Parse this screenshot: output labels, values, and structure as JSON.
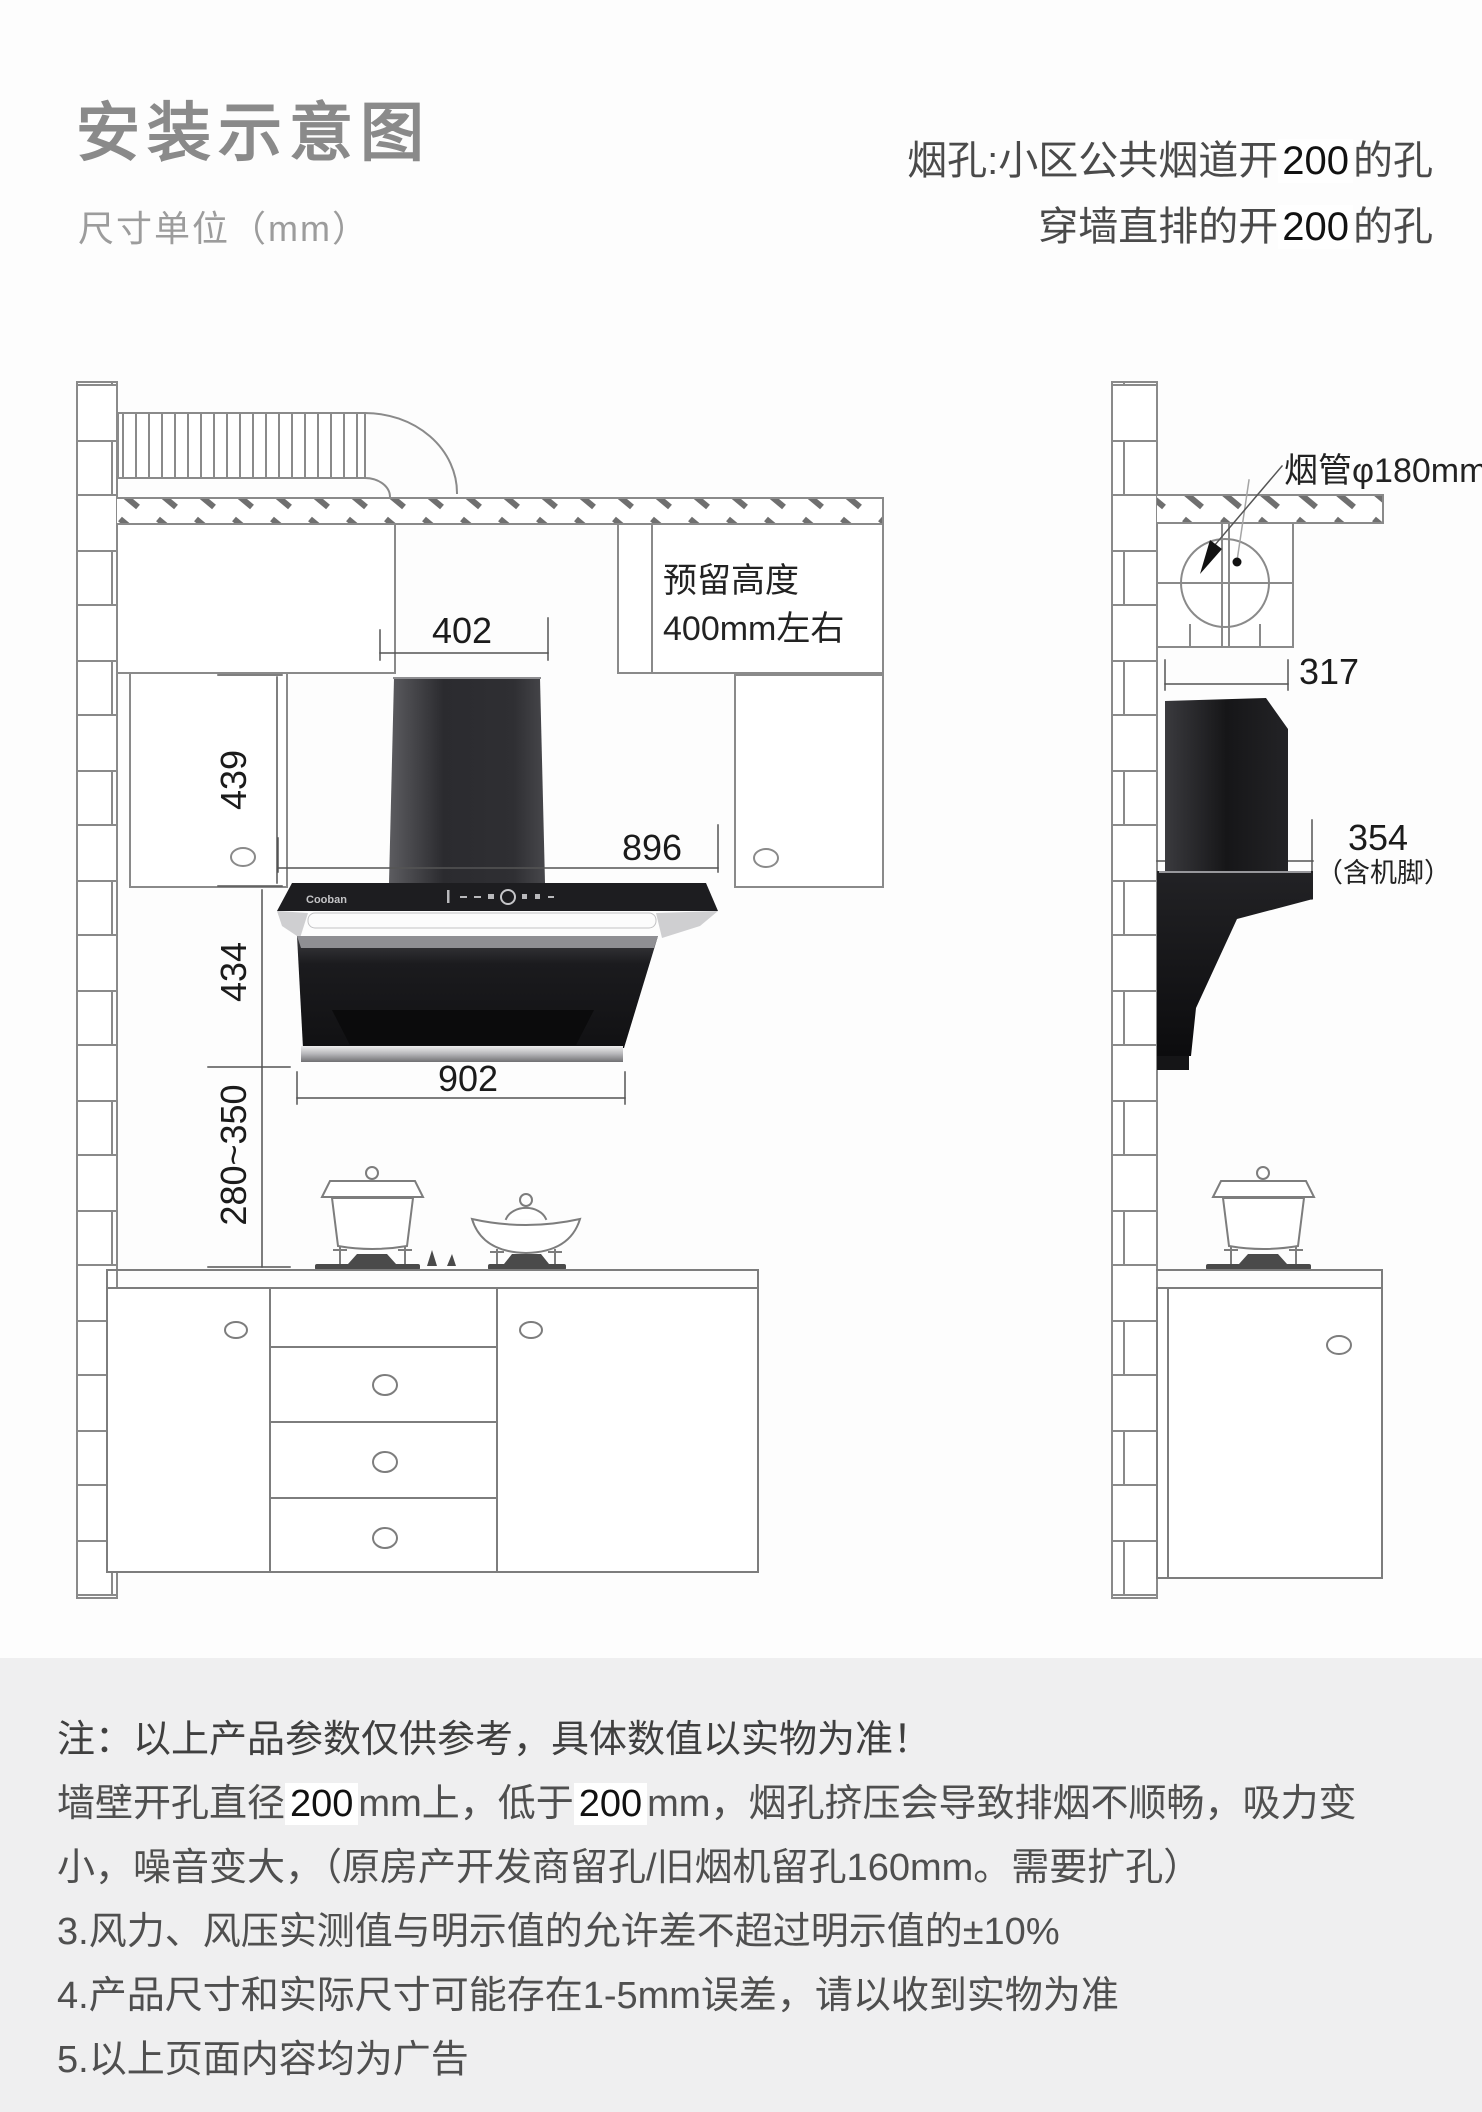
{
  "header": {
    "title": "安装示意图",
    "subtitle": "尺寸单位（mm）",
    "right_note": {
      "l1p": "烟孔:小区公共烟道开",
      "l1n": "200",
      "l1s": "的孔",
      "l2p": "穿墙直排的开",
      "l2n": "200",
      "l2s": "的孔"
    }
  },
  "dims": {
    "d402": "402",
    "d439": "439",
    "d896": "896",
    "d434": "434",
    "d902": "902",
    "d280": "280~350",
    "d317": "317",
    "d354": "354",
    "d354_sub": "（含机脚）"
  },
  "labels": {
    "reserve1": "预留高度",
    "reserve2": "400mm左右",
    "pipe": "烟管φ180mm",
    "brand": "Cooban"
  },
  "notes": {
    "line1": "注：以上产品参数仅供参考，具体数值以实物为准！",
    "line2": {
      "p1": "墙壁开孔直径",
      "n1": "200",
      "p2": "mm上，低于",
      "n2": "200",
      "p3": "mm，烟孔挤压会导致排烟不顺畅，吸力变"
    },
    "line3": "小，噪音变大，（原房产开发商留孔/旧烟机留孔160mm。需要扩孔）",
    "line4": "3.风力、风压实测值与明示值的允许差不超过明示值的±10%",
    "line5": "4.产品尺寸和实际尺寸可能存在1-5mm误差，请以收到实物为准",
    "line6": "5.以上页面内容均为广告"
  },
  "colors": {
    "line": "#8a8a8a",
    "dim_line": "#555555",
    "hood_dark": "#141416",
    "notes_bg": "#efeff0"
  }
}
